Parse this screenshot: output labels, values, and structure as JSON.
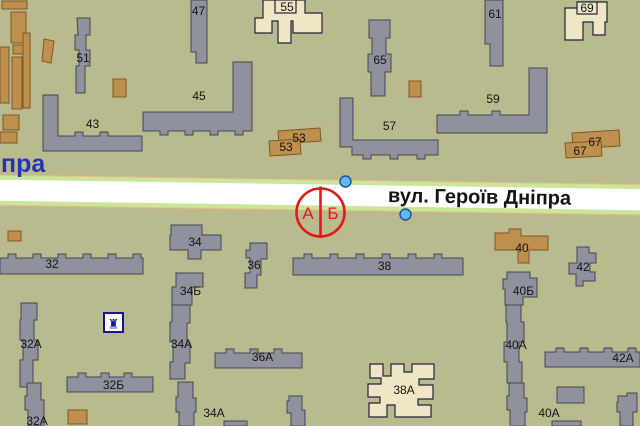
{
  "street": {
    "main_name": "вул. Героїв Дніпра",
    "partial_left": "пра"
  },
  "metro": {
    "exit_a": "А",
    "exit_b": "Б"
  },
  "poi": {
    "monument_glyph": "♜"
  },
  "colors": {
    "background": "#b9ba8d",
    "building_gray": "#8f919c",
    "building_tan": "#bf8f4e",
    "building_cream": "#f0e5c5",
    "road_white": "#ffffff",
    "road_edge_green": "#c9e69b",
    "road_edge_orange": "#e6c28a",
    "metro_red": "#e01a1a",
    "marker_blue": "#5fb8ef",
    "street_text": "#141414",
    "partial_street_text": "#2433b8",
    "poi_navy": "#14149b"
  },
  "buildings": [
    {
      "id": "47",
      "label": "47"
    },
    {
      "id": "51",
      "label": "51"
    },
    {
      "id": "55",
      "label": "55"
    },
    {
      "id": "45",
      "label": "45"
    },
    {
      "id": "43",
      "label": "43"
    },
    {
      "id": "53-upper",
      "label": "53"
    },
    {
      "id": "53-lower",
      "label": "53"
    },
    {
      "id": "65",
      "label": "65"
    },
    {
      "id": "61",
      "label": "61"
    },
    {
      "id": "69",
      "label": "69"
    },
    {
      "id": "59",
      "label": "59"
    },
    {
      "id": "57",
      "label": "57"
    },
    {
      "id": "67-upper",
      "label": "67"
    },
    {
      "id": "67-lower",
      "label": "67"
    },
    {
      "id": "34",
      "label": "34"
    },
    {
      "id": "32",
      "label": "32"
    },
    {
      "id": "36",
      "label": "36"
    },
    {
      "id": "34b",
      "label": "34Б"
    },
    {
      "id": "38",
      "label": "38"
    },
    {
      "id": "40",
      "label": "40"
    },
    {
      "id": "42",
      "label": "42"
    },
    {
      "id": "40b",
      "label": "40Б"
    },
    {
      "id": "32a-north",
      "label": "32А"
    },
    {
      "id": "34a-north",
      "label": "34А"
    },
    {
      "id": "36a",
      "label": "36А"
    },
    {
      "id": "40a-north",
      "label": "40А"
    },
    {
      "id": "42a",
      "label": "42А"
    },
    {
      "id": "32b",
      "label": "32Б"
    },
    {
      "id": "38a",
      "label": "38А"
    },
    {
      "id": "34a-south",
      "label": "34А"
    },
    {
      "id": "32a-south",
      "label": "32А"
    },
    {
      "id": "40a-south",
      "label": "40А"
    }
  ]
}
